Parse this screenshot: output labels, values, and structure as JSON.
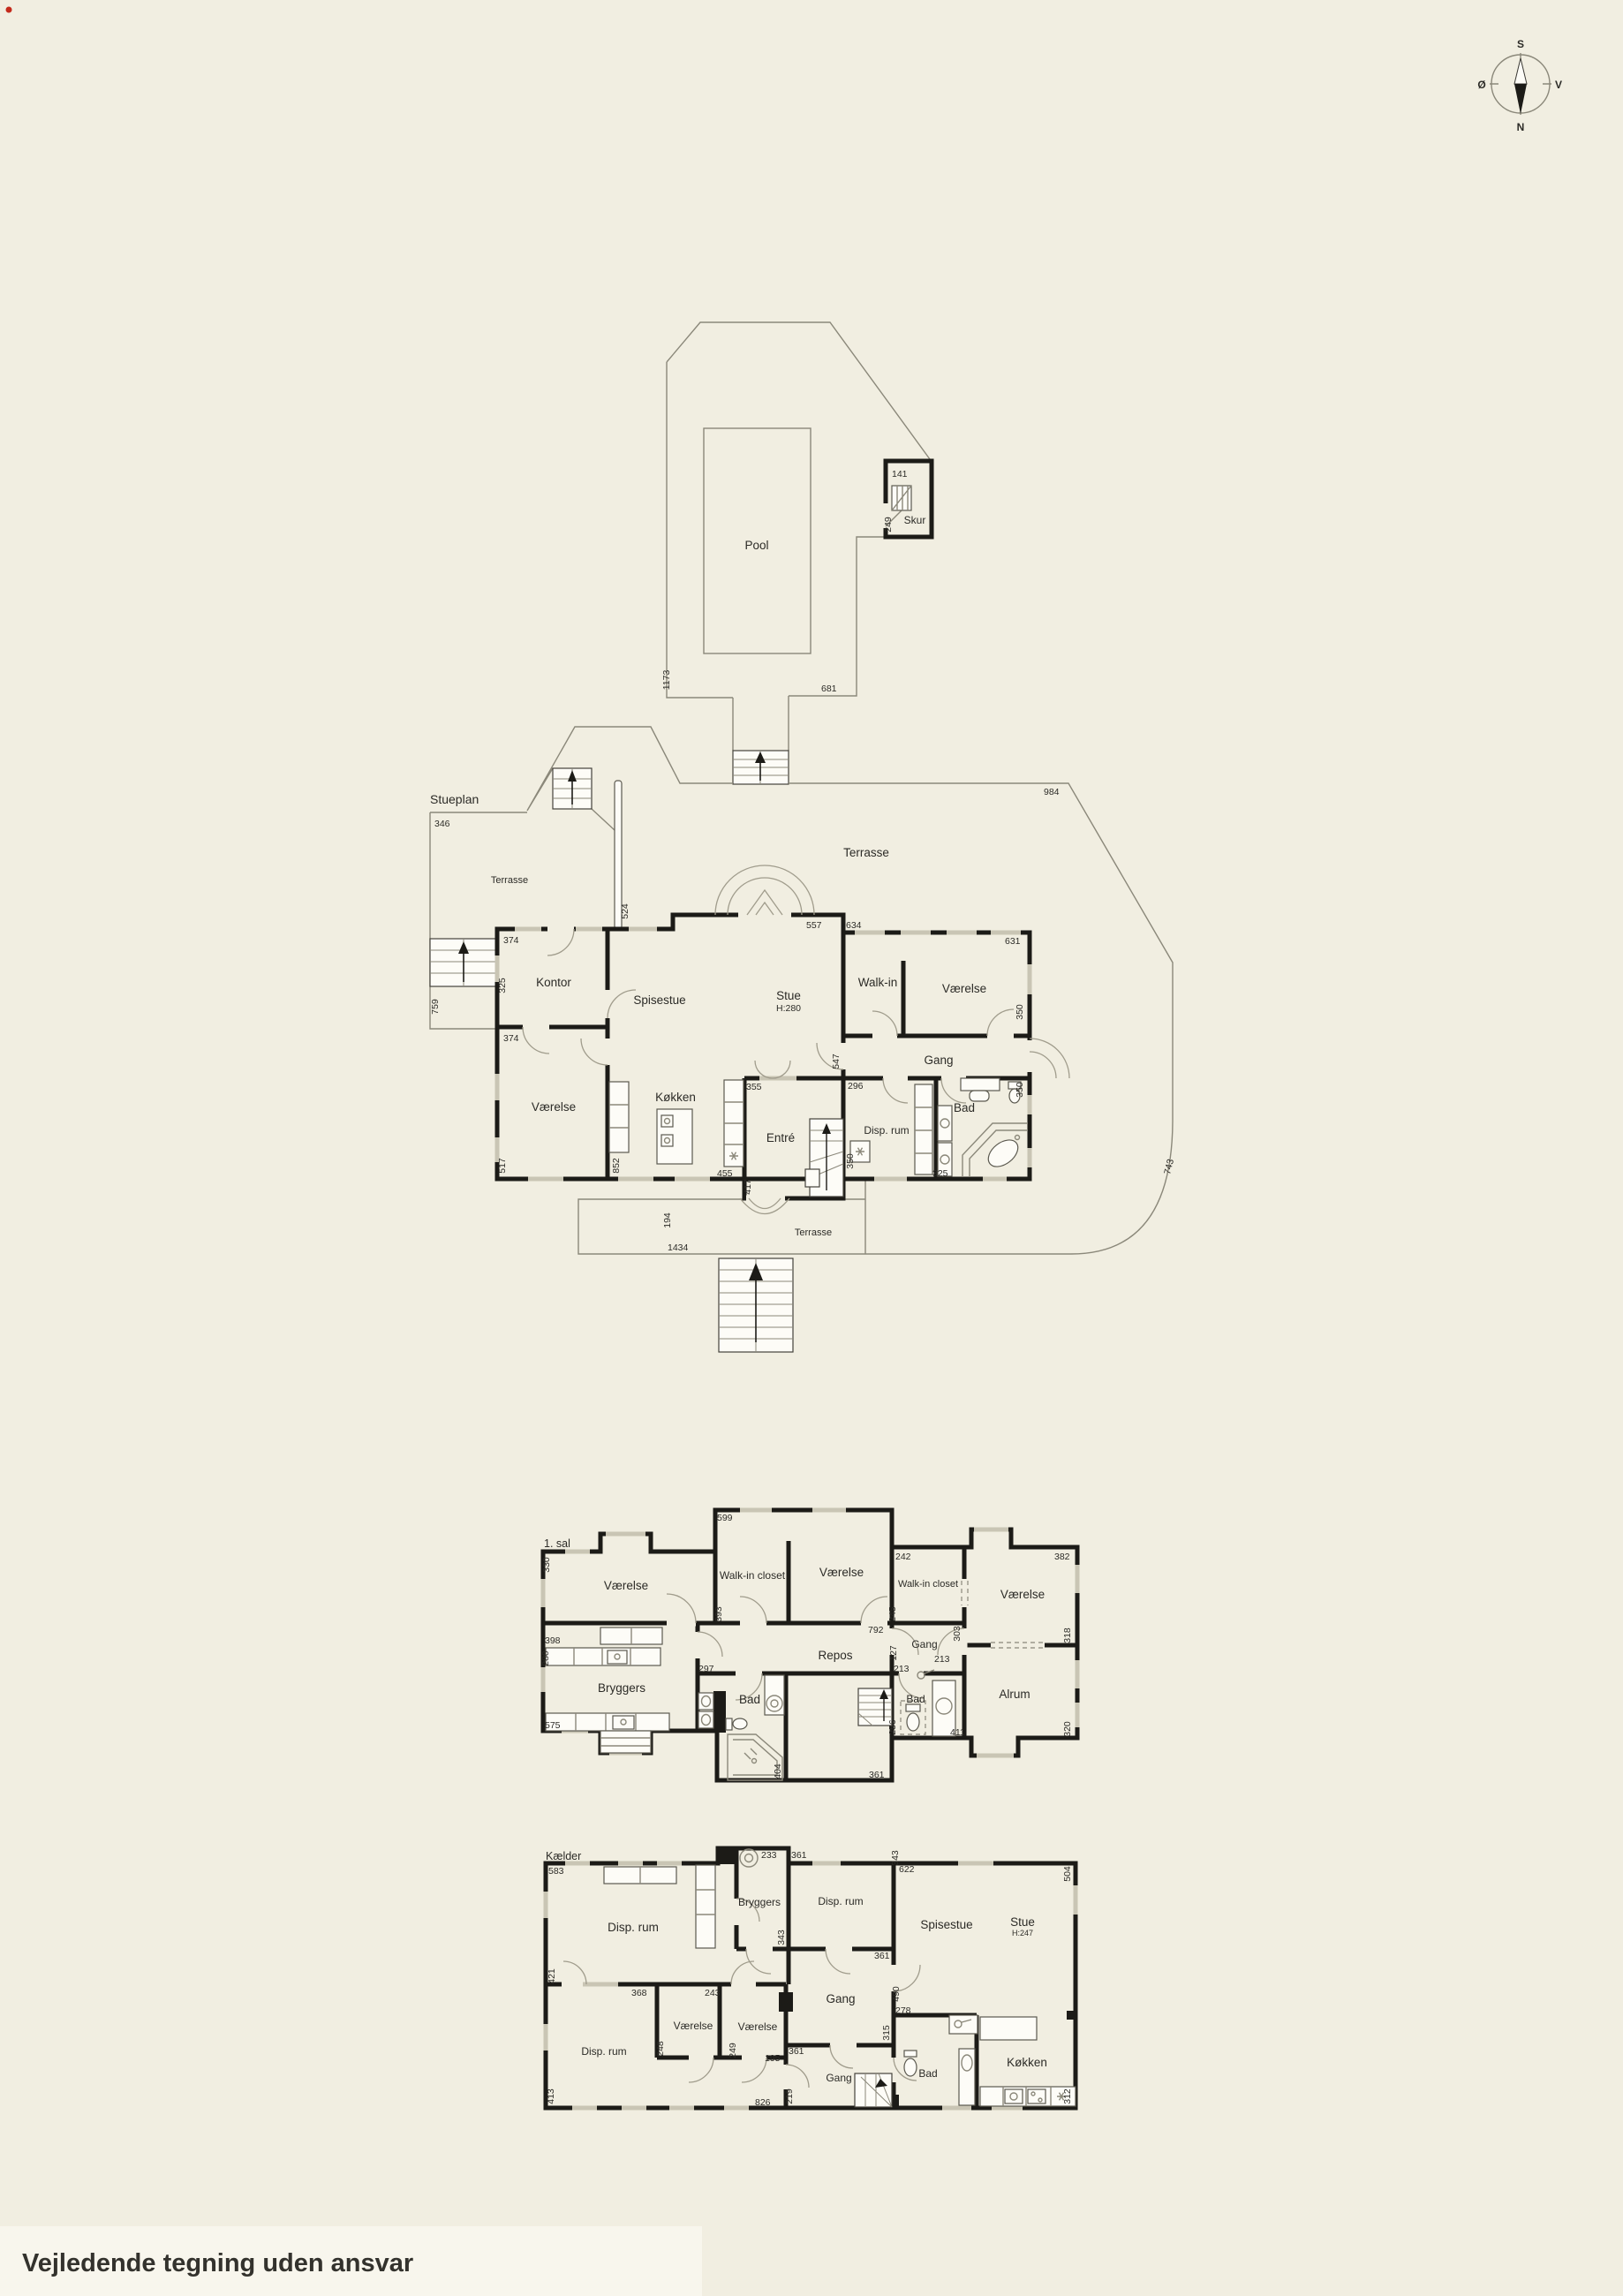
{
  "meta": {
    "bottom_note": "Vejledende tegning uden ansvar"
  },
  "compass": {
    "n": "N",
    "s": "S",
    "e": "Ø",
    "w": "V"
  },
  "site": {
    "pool": "Pool",
    "skur": "Skur",
    "dims": [
      "141",
      "249",
      "1173",
      "681",
      "984",
      "743"
    ]
  },
  "stueplan": {
    "label": "Stueplan",
    "rooms": {
      "terrasse_left": "Terrasse",
      "terrasse_top": "Terrasse",
      "terrasse_front": "Terrasse",
      "kontor": "Kontor",
      "vaerelse_v": "Værelse",
      "spisestue": "Spisestue",
      "stue": "Stue",
      "stue_h": "H:280",
      "walkin": "Walk-in",
      "vaerelse_o": "Værelse",
      "gang": "Gang",
      "koekken": "Køkken",
      "entre": "Entré",
      "disp_rum": "Disp. rum",
      "bad": "Bad"
    },
    "dims": [
      "346",
      "524",
      "374",
      "325",
      "374",
      "759",
      "517",
      "852",
      "355",
      "455",
      "417",
      "194",
      "1434",
      "557",
      "634",
      "631",
      "547",
      "296",
      "350",
      "350",
      "325",
      "350"
    ]
  },
  "sal1": {
    "label": "1. sal",
    "rooms": {
      "vaerelse_tl": "Værelse",
      "walkin_1": "Walk-in closet",
      "vaerelse_tc": "Værelse",
      "walkin_2": "Walk-in closet",
      "vaerelse_tr": "Værelse",
      "gang": "Gang",
      "repos": "Repos",
      "bryggers": "Bryggers",
      "bad_c": "Bad",
      "bad_r": "Bad",
      "alrum": "Alrum"
    },
    "dims": [
      "599",
      "330",
      "242",
      "382",
      "393",
      "245",
      "792",
      "398",
      "280",
      "127",
      "213",
      "213",
      "297",
      "318",
      "575",
      "404",
      "361",
      "256",
      "411",
      "320",
      "303"
    ]
  },
  "kaelder": {
    "label": "Kælder",
    "rooms": {
      "disp_tl": "Disp. rum",
      "bryggers": "Bryggers",
      "disp_tr": "Disp. rum",
      "spisestue": "Spisestue",
      "stue": "Stue",
      "stue_h": "H:247",
      "gang_u": "Gang",
      "vaerelse_1": "Værelse",
      "vaerelse_2": "Værelse",
      "disp_bl": "Disp. rum",
      "gang_l": "Gang",
      "bad": "Bad",
      "koekken": "Køkken"
    },
    "dims": [
      "583",
      "233",
      "361",
      "343",
      "343",
      "622",
      "504",
      "421",
      "368",
      "243",
      "361",
      "490",
      "278",
      "248",
      "249",
      "195",
      "361",
      "413",
      "826",
      "219",
      "315",
      "312"
    ]
  }
}
